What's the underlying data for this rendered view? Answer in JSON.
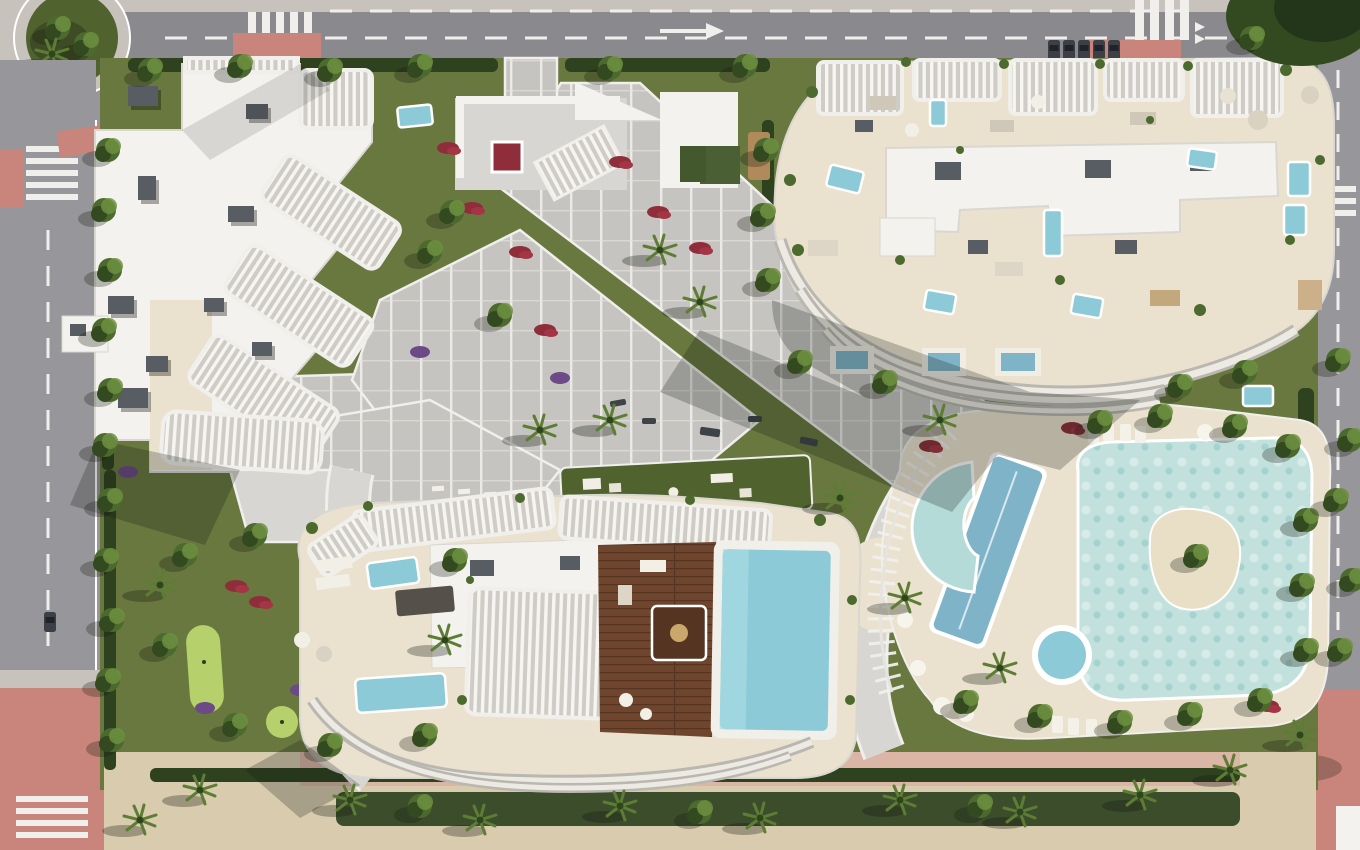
{
  "scene": {
    "kind": "aerial-architectural-render",
    "areas": [
      "perimeter-roads",
      "roundabout",
      "northwest-apartment-tower",
      "northeast-apartment-tower",
      "south-apartment-tower",
      "central-promenade",
      "outdoor-gym-lawn",
      "mini-golf-garden",
      "lagoon-pool",
      "lap-pool",
      "spa-pool",
      "rooftop-pool",
      "pool-deck",
      "gardens",
      "beach-strip"
    ]
  },
  "colors": {
    "road": "#97969a",
    "roadDark": "#8a898d",
    "sidewalk": "#c7c3bc",
    "stripe": "#f0efec",
    "pinkPave": "#c9857b",
    "pinkPaveLight": "#dcb2a4",
    "sand": "#d8cbae",
    "sandLight": "#e4d8bf",
    "lawn": "#69783f",
    "lawnDark": "#50632f",
    "lawnLight": "#8fae54",
    "puttGreen": "#b6d16c",
    "hedge": "#2e421f",
    "tree": "#4d6a2e",
    "treeDark": "#33491f",
    "treeLight": "#6d8f3f",
    "palm": "#5d7d35",
    "path": "#c6c4c0",
    "pathLight": "#d8d6d2",
    "roofWhite": "#f3f2ee",
    "roofShade": "#d9d7d0",
    "terraceCream": "#eae2cf",
    "boxGray": "#585d63",
    "deckWood": "#70452e",
    "deckWoodDark": "#553421",
    "poolLagoon": "#c2e1dd",
    "poolLagoonDeep": "#9ecfcd",
    "poolLap": "#7fb4c8",
    "poolBlue": "#8ccad7",
    "islandSand": "#e8dfc6",
    "flowerRed": "#8f2e3a",
    "flowerCrimson": "#a43545",
    "flowerPurple": "#6b4a87"
  }
}
